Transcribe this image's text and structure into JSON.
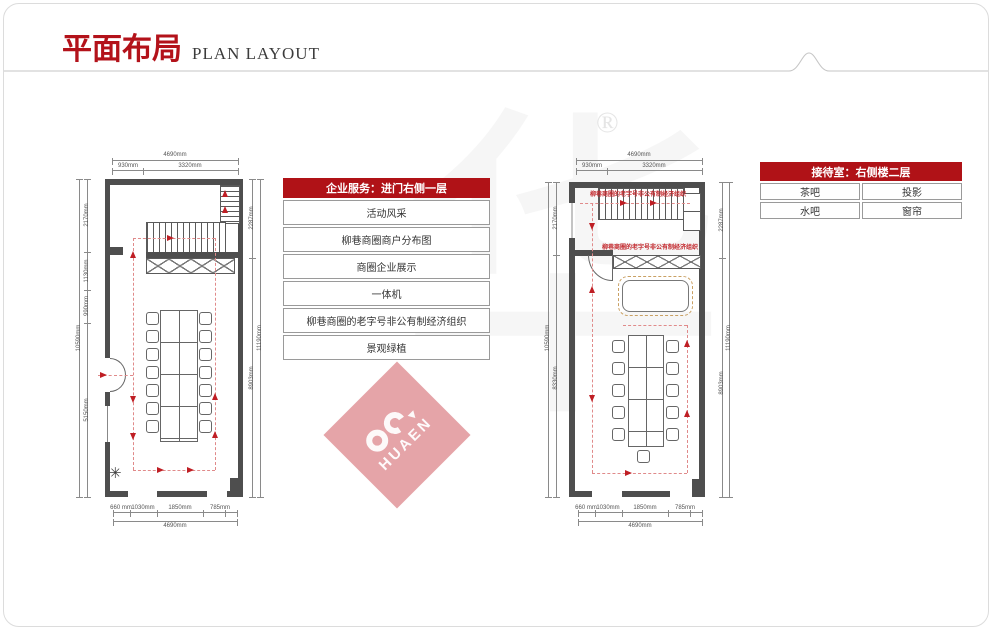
{
  "header": {
    "title_zh": "平面布局",
    "title_en": "PLAN LAYOUT"
  },
  "service_table": {
    "header": "企业服务：进门右侧一层",
    "rows": [
      "活动风采",
      "柳巷商圈商户分布图",
      "商圈企业展示",
      "一体机",
      "柳巷商圈的老字号非公有制经济组织",
      "景观绿植"
    ]
  },
  "reception_table": {
    "header": "接待室：右侧楼二层",
    "rows": [
      [
        "茶吧",
        "投影"
      ],
      [
        "水吧",
        "窗帘"
      ]
    ]
  },
  "left_plan": {
    "top_total": "4690mm",
    "top_seg1": "930mm",
    "top_seg2": "3320mm",
    "bottom_seg1": "660 mm",
    "bottom_seg2": "1030mm",
    "bottom_seg3": "1850mm",
    "bottom_seg4": "785mm",
    "bottom_total": "4690mm",
    "left_seg1": "2170mm",
    "left_seg2": "1130mm",
    "left_seg3": "990mm",
    "left_seg4": "5150mm",
    "left_total": "10590mm",
    "right_seg1": "2287mm",
    "right_seg2": "8903mm",
    "right_total": "11190mm"
  },
  "right_plan": {
    "annotation_top": "柳巷商圈的老字号非公有制经济组织",
    "annotation_mid": "柳巷商圈的老字号非公有制经济组织",
    "top_total": "4690mm",
    "top_seg1": "930mm",
    "top_seg2": "3320mm",
    "bottom_seg1": "660 mm",
    "bottom_seg2": "1030mm",
    "bottom_seg3": "1850mm",
    "bottom_seg4": "785mm",
    "bottom_total": "4690mm",
    "left_seg1": "2170mm",
    "left_seg2": "8330mm",
    "left_total": "10590mm",
    "right_seg1": "2287mm",
    "right_seg2": "8903mm",
    "right_total": "11190mm"
  },
  "watermark": {
    "logo_text": "HUAEN",
    "registered": "®",
    "ghost": "华"
  },
  "colors": {
    "accent_red": "#b01217",
    "title_red": "#b3121a",
    "wall_gray": "#4e4e4e",
    "path_red": "#e08a8a",
    "arrow_red": "#bf1e24",
    "watermark_pink": "rgba(192,38,47,0.42)"
  }
}
